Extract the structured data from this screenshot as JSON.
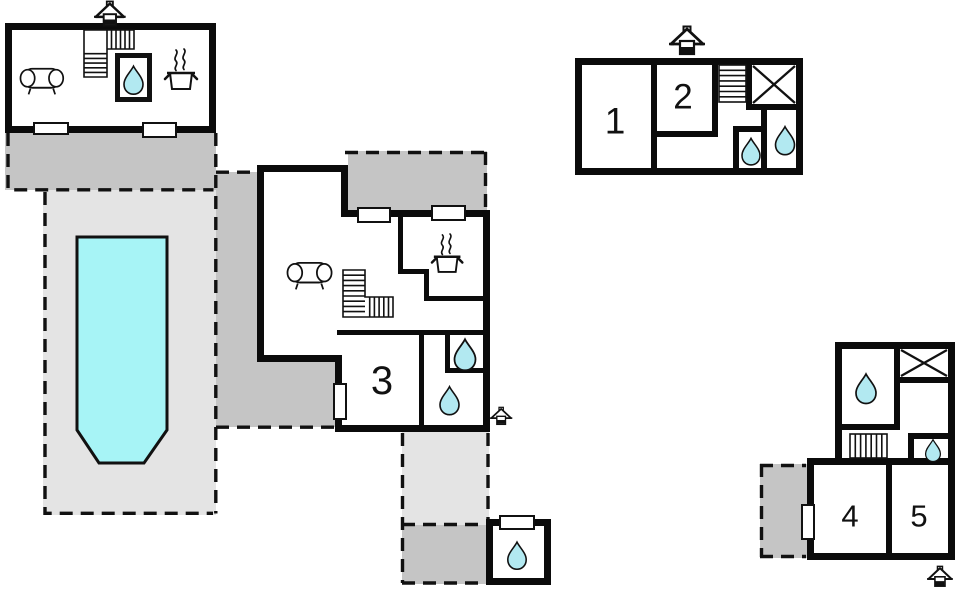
{
  "plan": {
    "type": "floor-plan",
    "rooms": [
      {
        "id": "room-1",
        "number": "1"
      },
      {
        "id": "room-2",
        "number": "2"
      },
      {
        "id": "room-3",
        "number": "3"
      },
      {
        "id": "room-4",
        "number": "4"
      },
      {
        "id": "room-5",
        "number": "5"
      }
    ],
    "colors": {
      "wall": "#0b0b0b",
      "terrace_dark": "#c5c5c5",
      "terrace_light": "#e4e4e4",
      "pool_water": "#a7f4f6",
      "water_drop": "#b2e9f1",
      "background": "#ffffff"
    },
    "icons": {
      "entrance": "house-entrance-icon",
      "bathroom": "water-drop-icon",
      "kitchen": "cooking-pot-icon",
      "living_area": "sofa-icon",
      "stairs": "stairs-icon",
      "roof_window": "window-x-icon"
    }
  }
}
